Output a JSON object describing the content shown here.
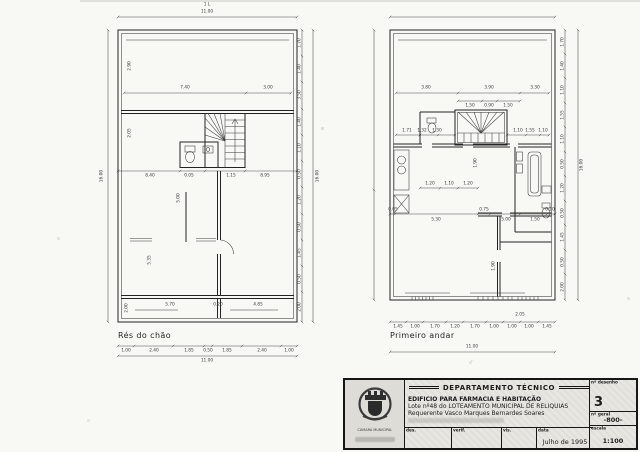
{
  "page": {
    "paper": "#f8f8f5",
    "ink": "#222222",
    "title_block_bg": "#e7e6e1"
  },
  "plans": {
    "ground": {
      "name": "Rés do chão",
      "annotations": [
        {
          "t": "1 L",
          "x": 157,
          "y": 5
        },
        {
          "t": "11.00",
          "x": 157,
          "y": 12
        },
        {
          "t": "16.00",
          "x": 52,
          "y": 176,
          "r": -90
        },
        {
          "t": "7.40",
          "x": 135,
          "y": 88
        },
        {
          "t": "3.00",
          "x": 218,
          "y": 88
        },
        {
          "t": "2.90",
          "x": 80,
          "y": 66,
          "r": -90
        },
        {
          "t": "2.05",
          "x": 80,
          "y": 133,
          "r": -90
        },
        {
          "t": "8.40",
          "x": 100,
          "y": 176
        },
        {
          "t": "0.05",
          "x": 139,
          "y": 176
        },
        {
          "t": "1.15",
          "x": 181,
          "y": 176
        },
        {
          "t": "8.95",
          "x": 215,
          "y": 176
        },
        {
          "t": "5.00",
          "x": 129,
          "y": 198,
          "r": -90
        },
        {
          "t": "5.35",
          "x": 100,
          "y": 260,
          "r": -90
        },
        {
          "t": "5.70",
          "x": 120,
          "y": 305
        },
        {
          "t": "0.20",
          "x": 168,
          "y": 305
        },
        {
          "t": "4.85",
          "x": 208,
          "y": 305
        },
        {
          "t": "2.00",
          "x": 77,
          "y": 308,
          "r": -90
        },
        {
          "t": "1.00",
          "x": 76,
          "y": 351
        },
        {
          "t": "2.40",
          "x": 104,
          "y": 351
        },
        {
          "t": "1.85",
          "x": 139,
          "y": 351
        },
        {
          "t": "0.50",
          "x": 158,
          "y": 351
        },
        {
          "t": "1.85",
          "x": 177,
          "y": 351
        },
        {
          "t": "2.40",
          "x": 212,
          "y": 351
        },
        {
          "t": "1.00",
          "x": 239,
          "y": 351
        },
        {
          "t": "11.00",
          "x": 157,
          "y": 361
        },
        {
          "t": "1.70",
          "x": 250,
          "y": 43,
          "r": -90
        },
        {
          "t": "1.40",
          "x": 250,
          "y": 69,
          "r": -90
        },
        {
          "t": "3.50",
          "x": 250,
          "y": 95,
          "r": -90
        },
        {
          "t": "1.40",
          "x": 250,
          "y": 122,
          "r": -90
        },
        {
          "t": "1.10",
          "x": 250,
          "y": 148,
          "r": -90
        },
        {
          "t": "0.50",
          "x": 250,
          "y": 174,
          "r": -90
        },
        {
          "t": "1.20",
          "x": 250,
          "y": 200,
          "r": -90
        },
        {
          "t": "0.50",
          "x": 250,
          "y": 227,
          "r": -90
        },
        {
          "t": "1.45",
          "x": 250,
          "y": 253,
          "r": -90
        },
        {
          "t": "0.50",
          "x": 250,
          "y": 279,
          "r": -90
        },
        {
          "t": "2.00",
          "x": 250,
          "y": 307,
          "r": -90
        },
        {
          "t": "16.00",
          "x": 268,
          "y": 176,
          "r": -90
        }
      ]
    },
    "first": {
      "name": "Primeiro andar",
      "annotations": [
        {
          "t": "3.80",
          "x": 66,
          "y": 88
        },
        {
          "t": "3.90",
          "x": 129,
          "y": 88
        },
        {
          "t": "3.30",
          "x": 175,
          "y": 88
        },
        {
          "t": "1.50",
          "x": 110,
          "y": 106
        },
        {
          "t": "0.90",
          "x": 129,
          "y": 106
        },
        {
          "t": "1.50",
          "x": 148,
          "y": 106
        },
        {
          "t": "1.71",
          "x": 47,
          "y": 131
        },
        {
          "t": "1.32",
          "x": 62,
          "y": 131
        },
        {
          "t": "1.30",
          "x": 77,
          "y": 131
        },
        {
          "t": "1.10",
          "x": 158,
          "y": 131
        },
        {
          "t": "1.55",
          "x": 170,
          "y": 131
        },
        {
          "t": "1.10",
          "x": 183,
          "y": 131
        },
        {
          "t": "1.20",
          "x": 70,
          "y": 184
        },
        {
          "t": "1.10",
          "x": 89,
          "y": 184
        },
        {
          "t": "1.20",
          "x": 108,
          "y": 184
        },
        {
          "t": "1.90",
          "x": 116,
          "y": 163,
          "r": -90
        },
        {
          "t": "0.05",
          "x": 33,
          "y": 210
        },
        {
          "t": "5.30",
          "x": 76,
          "y": 220
        },
        {
          "t": "0.75",
          "x": 124,
          "y": 210
        },
        {
          "t": "5.00",
          "x": 146,
          "y": 220
        },
        {
          "t": "1.50",
          "x": 175,
          "y": 220
        },
        {
          "t": "0.10",
          "x": 190,
          "y": 210
        },
        {
          "t": "1.90",
          "x": 134,
          "y": 266,
          "r": -90
        },
        {
          "t": "2.05",
          "x": 160,
          "y": 315
        },
        {
          "t": "1.45",
          "x": 38,
          "y": 327
        },
        {
          "t": "1.00",
          "x": 55,
          "y": 327
        },
        {
          "t": "1.70",
          "x": 75,
          "y": 327
        },
        {
          "t": "1.20",
          "x": 95,
          "y": 327
        },
        {
          "t": "1.70",
          "x": 115,
          "y": 327
        },
        {
          "t": "1.00",
          "x": 134,
          "y": 327
        },
        {
          "t": "1.00",
          "x": 152,
          "y": 327
        },
        {
          "t": "1.00",
          "x": 169,
          "y": 327
        },
        {
          "t": "1.45",
          "x": 187,
          "y": 327
        },
        {
          "t": "11.00",
          "x": 112,
          "y": 347
        },
        {
          "t": ".",
          "x": 112,
          "y": 360
        },
        {
          "t": "1.70",
          "x": 203,
          "y": 42,
          "r": -90
        },
        {
          "t": "1.40",
          "x": 203,
          "y": 66,
          "r": -90
        },
        {
          "t": "1.10",
          "x": 203,
          "y": 90,
          "r": -90
        },
        {
          "t": "1.55",
          "x": 203,
          "y": 115,
          "r": -90
        },
        {
          "t": "1.10",
          "x": 203,
          "y": 139,
          "r": -90
        },
        {
          "t": "0.50",
          "x": 203,
          "y": 164,
          "r": -90
        },
        {
          "t": "1.20",
          "x": 203,
          "y": 188,
          "r": -90
        },
        {
          "t": "0.50",
          "x": 203,
          "y": 213,
          "r": -90
        },
        {
          "t": "1.45",
          "x": 203,
          "y": 237,
          "r": -90
        },
        {
          "t": "0.50",
          "x": 203,
          "y": 262,
          "r": -90
        },
        {
          "t": "2.00",
          "x": 203,
          "y": 287,
          "r": -90
        },
        {
          "t": "16.00",
          "x": 222,
          "y": 165,
          "r": -90
        }
      ]
    }
  },
  "title_block": {
    "municipality": "CÂMARA MUNICIPAL",
    "department": "DEPARTAMENTO TÉCNICO",
    "project_title": "EDIFICIO PARA FARMACIA E HABITAÇÃO",
    "project_subtitle": "Lote nº48 do LOTEAMENTO MUNICIPAL DE RELIQUIAS",
    "applicant": "Requerente Vasco Marques Bernardes Soares",
    "drawing_no_label": "nº desenho",
    "drawing_no": "3",
    "general_no_label": "nº geral",
    "general_no": "-800-",
    "scale_label": "escala",
    "scale_value": "1:100",
    "date_label": "data",
    "date_value": "Julho de 1995",
    "sign_des": "des.",
    "sign_verif": "verif.",
    "sign_vis": "vis."
  }
}
